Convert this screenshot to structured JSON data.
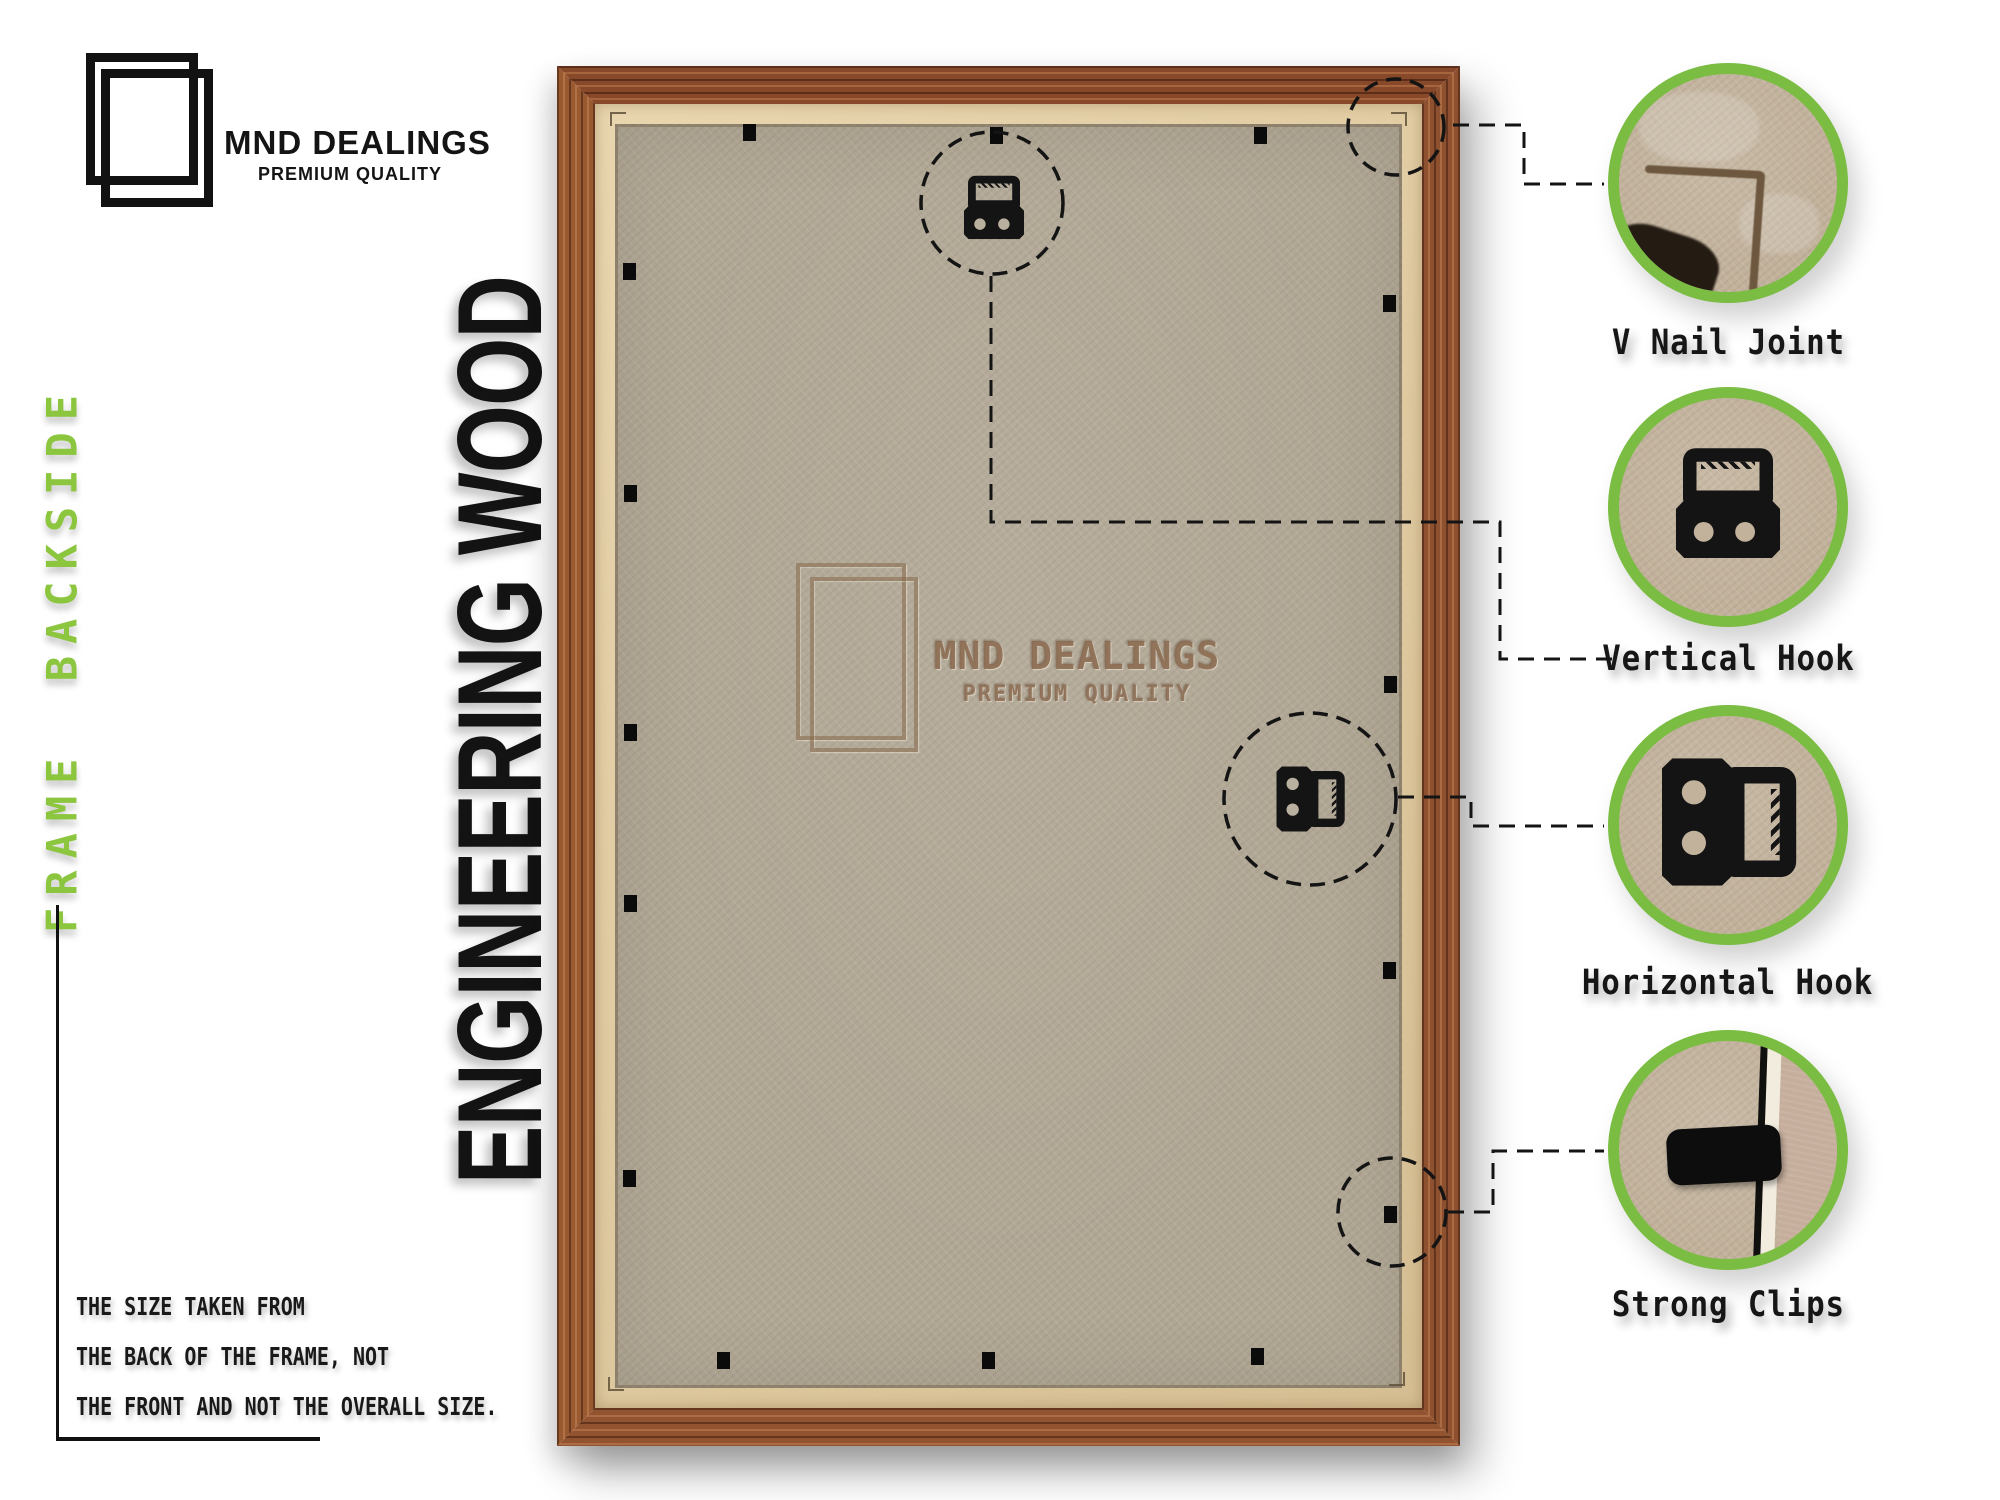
{
  "brand": {
    "name": "MND DEALINGS",
    "tagline": "PREMIUM QUALITY"
  },
  "side_label": "FRAME BACKSIDE",
  "material_label": "ENGINEERING WOOD",
  "note": {
    "lines": [
      "THE SIZE TAKEN FROM",
      "THE BACK OF THE FRAME, NOT",
      "THE FRONT AND NOT THE OVERALL SIZE."
    ]
  },
  "watermark": {
    "name": "MND DEALINGS",
    "tagline": "PREMIUM QUALITY"
  },
  "callouts": [
    {
      "id": "v-nail-joint",
      "label": "V Nail Joint"
    },
    {
      "id": "vertical-hook",
      "label": "Vertical Hook"
    },
    {
      "id": "horizontal-hook",
      "label": "Horizontal Hook"
    },
    {
      "id": "strong-clips",
      "label": "Strong Clips"
    }
  ],
  "colors": {
    "accent_green": "#7abd42",
    "side_label_green": "#8cc63e",
    "label_text": "#161616",
    "wood_brown": "#8a4e2c",
    "frame_lip_tan": "#dcc69d",
    "backing_grey_tan": "#b1a795",
    "cardboard_tan": "#c2b29c",
    "watermark_brown": "#94755a"
  }
}
